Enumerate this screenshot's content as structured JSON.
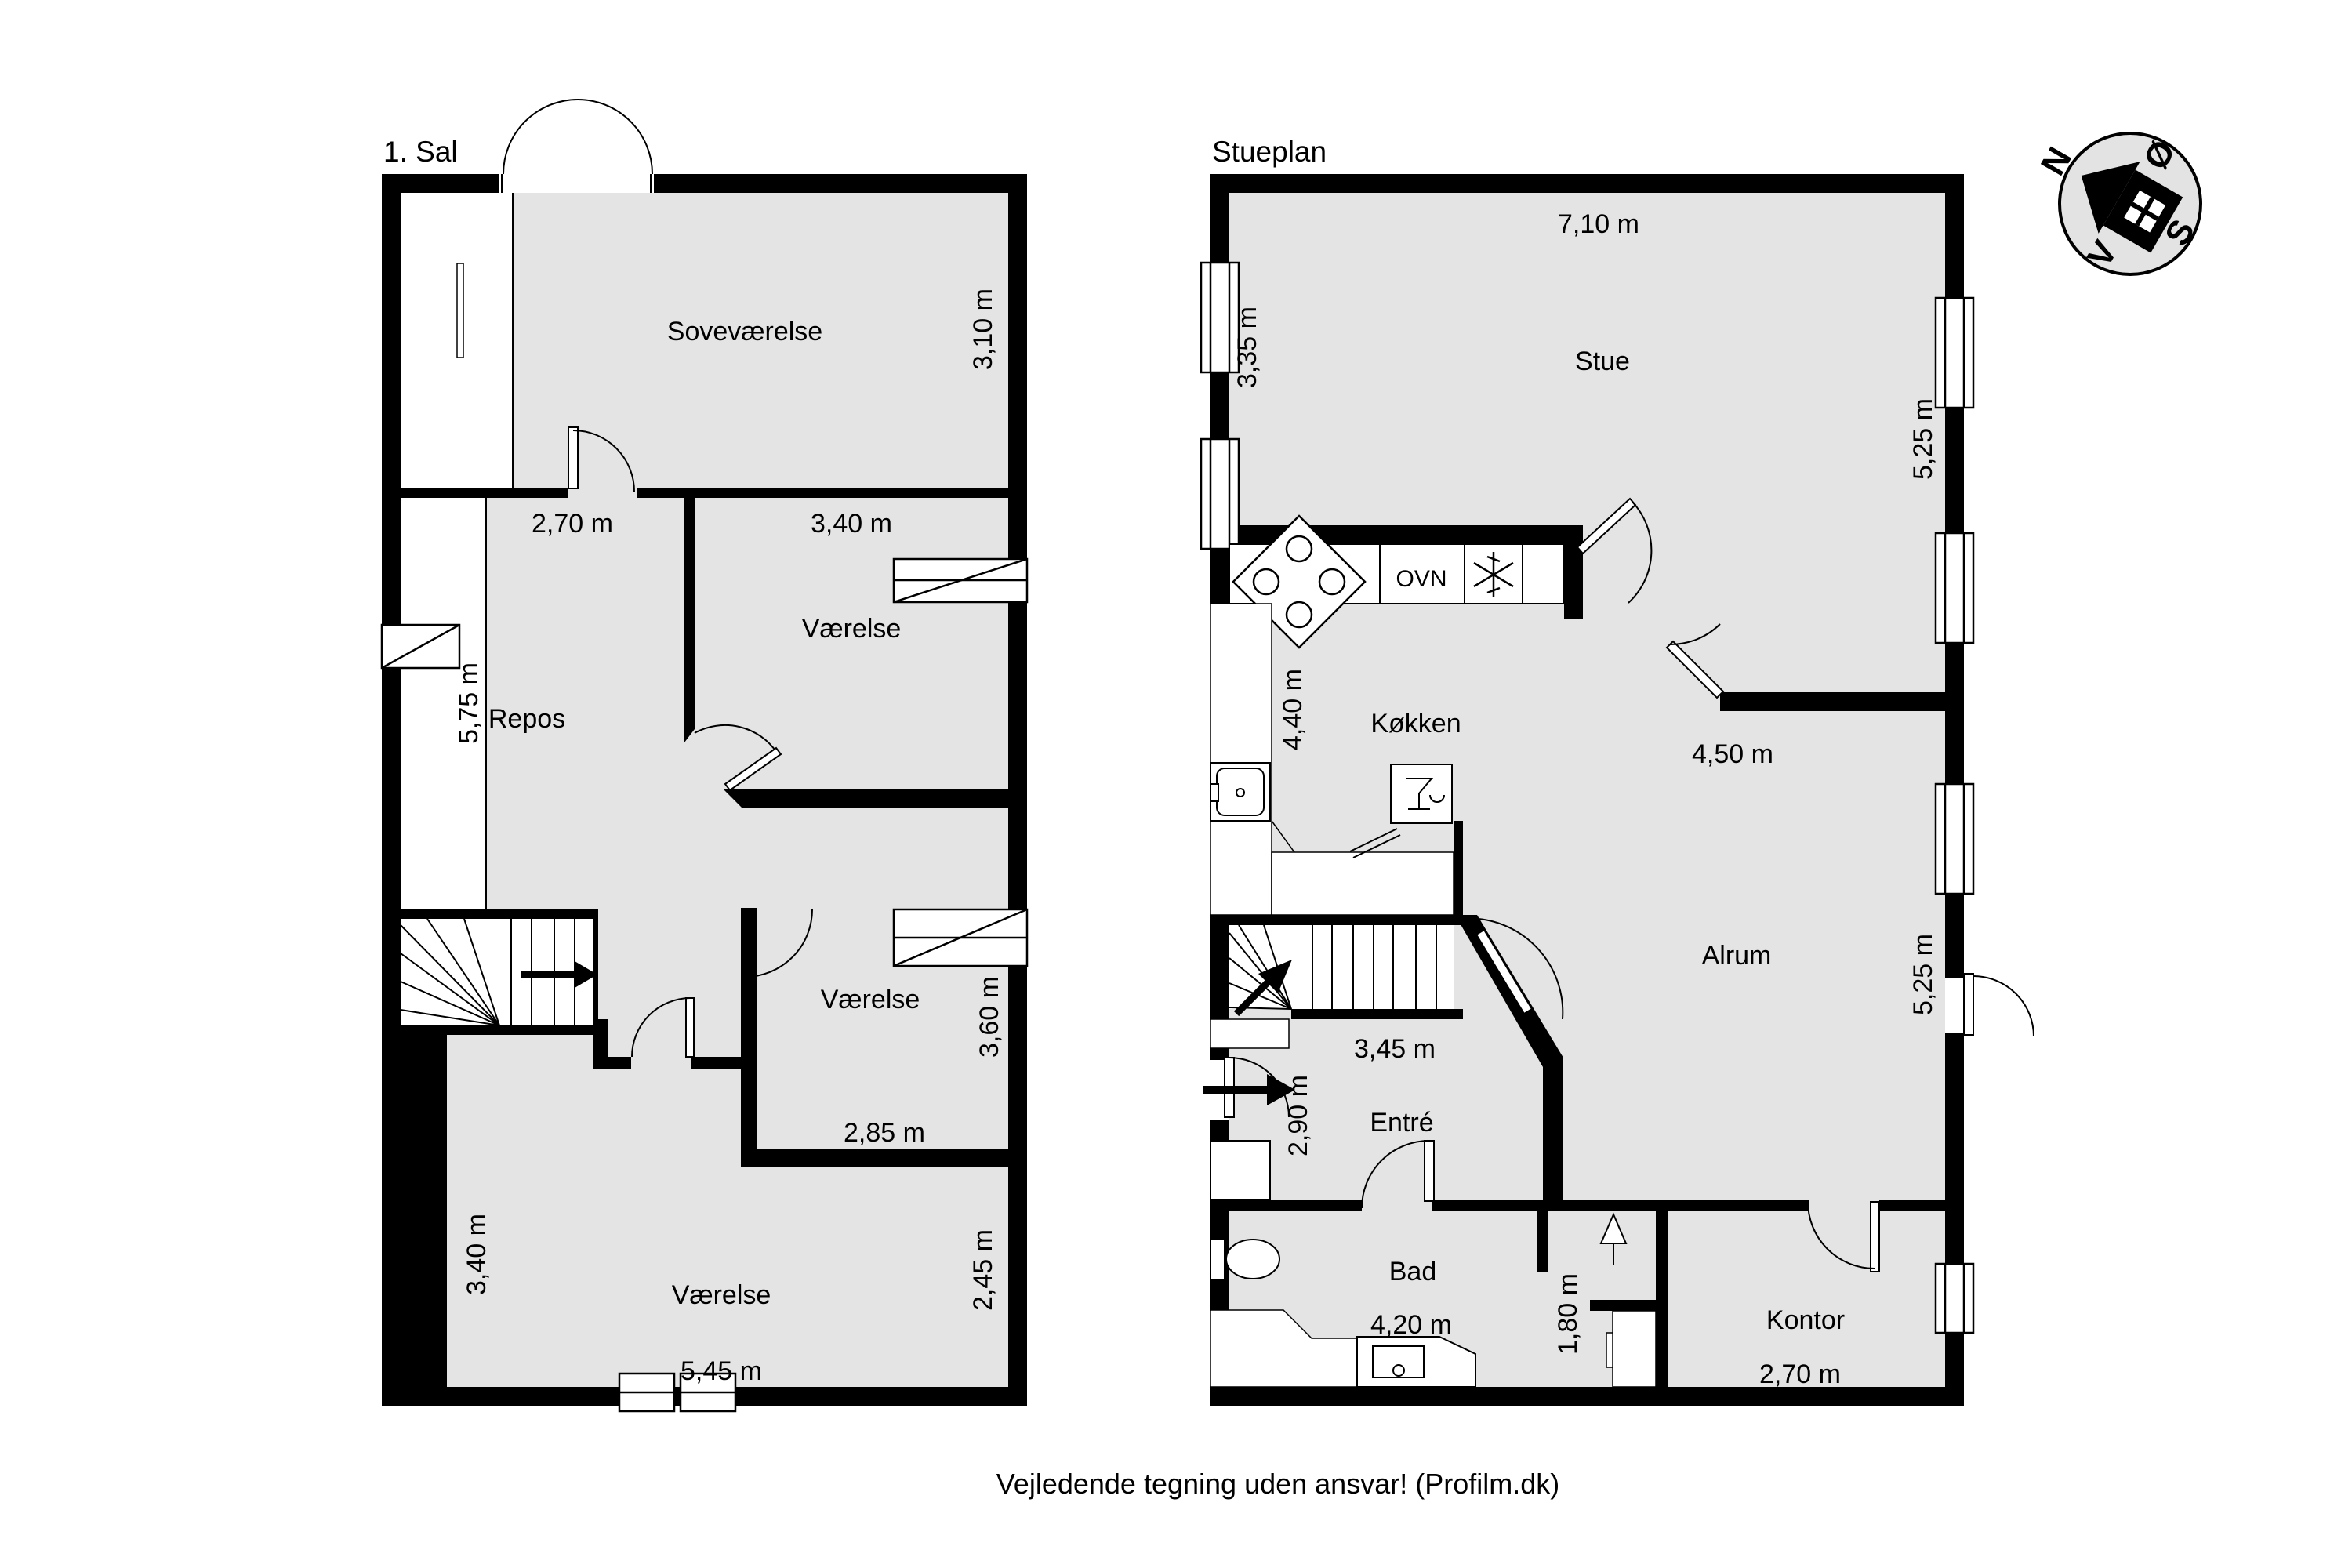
{
  "sal": {
    "title": "1. Sal",
    "rooms": {
      "sovevaerelse": "Soveværelse",
      "vaerelse_top": "Værelse",
      "repos": "Repos",
      "vaerelse_mid": "Værelse",
      "vaerelse_bottom": "Værelse"
    },
    "dims": {
      "d310": "3,10 m",
      "d270": "2,70 m",
      "d340": "3,40 m",
      "d575": "5,75 m",
      "d360": "3,60 m",
      "d285": "2,85 m",
      "d340b": "3,40 m",
      "d245": "2,45 m",
      "d545": "5,45 m"
    }
  },
  "stueplan": {
    "title": "Stueplan",
    "rooms": {
      "stue": "Stue",
      "koekken": "Køkken",
      "alrum": "Alrum",
      "entre": "Entré",
      "bad": "Bad",
      "kontor": "Kontor"
    },
    "appliances": {
      "ovn": "OVN"
    },
    "dims": {
      "d710": "7,10 m",
      "d335": "3,35 m",
      "d525a": "5,25 m",
      "d440": "4,40 m",
      "d450": "4,50 m",
      "d525b": "5,25 m",
      "d345": "3,45 m",
      "d290": "2,90 m",
      "d420": "4,20 m",
      "d180": "1,80 m",
      "d270": "2,70 m"
    }
  },
  "compass": {
    "north": "N",
    "east": "Ø",
    "south": "S",
    "west": "V"
  },
  "footer": {
    "disclaimer": "Vejledende tegning uden ansvar! (Profilm.dk)"
  },
  "colors": {
    "floor": "#e4e4e4",
    "wall": "#000000",
    "compass_fill": "#e3e3e3"
  }
}
